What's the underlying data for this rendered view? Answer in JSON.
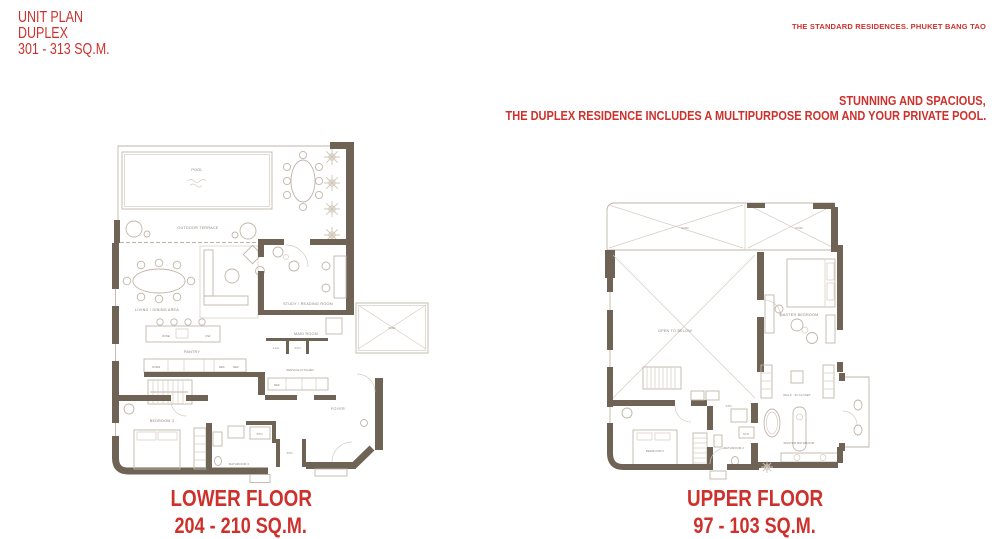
{
  "page": {
    "title": "UNIT PLAN",
    "subtitle": "DUPLEX",
    "size_range": "301 - 313 SQ.M.",
    "brand": "THE STANDARD RESIDENCES. PHUKET BANG TAO",
    "tagline_line1": "STUNNING AND SPACIOUS,",
    "tagline_line2": "THE DUPLEX RESIDENCE INCLUDES A MULTIPURPOSE ROOM AND YOUR PRIVATE POOL."
  },
  "colors": {
    "accent_red": "#ce312c",
    "wall": "#6e6355",
    "furniture_line": "#bfb6aa"
  },
  "lower_floor": {
    "caption": "LOWER FLOOR",
    "area": "204 - 210 SQ.M.",
    "labels": {
      "pool": "POOL",
      "outdoor_terrace": "OUTDOOR TERRACE",
      "living_dining": "LIVING / DINING AREA",
      "wine": "WINE",
      "dw": "DW",
      "pantry": "PANTRY",
      "oven": "OVEN",
      "ref1": "REF",
      "ref2": "REF",
      "study": "STUDY / READING ROOM",
      "maid_room": "MAID ROOM",
      "lau": "LAU",
      "sto1": "STO.",
      "service_kitchen": "SERVICE KITCHEN",
      "ref3": "REF",
      "void": "VOID",
      "foyer": "FOYER",
      "bedroom3": "BEDROOM 3",
      "bathroom3": "BATHROOM 3",
      "sto2": "STO.",
      "sto3": "STO."
    }
  },
  "upper_floor": {
    "caption": "UPPER FLOOR",
    "area": "97 - 103 SQ.M.",
    "labels": {
      "void1": "VOID",
      "void2": "VOID",
      "open_to_below": "OPEN TO BELOW",
      "master_bedroom": "MASTER BEDROOM",
      "walk_in_closet": "WALK - IN CLOSET",
      "master_bathroom": "MASTER BATHROOM",
      "bedroom2": "BEDROOM 2",
      "bathroom2": "BATHROOM 2",
      "sto1": "STO.",
      "sto2": "STO."
    }
  }
}
